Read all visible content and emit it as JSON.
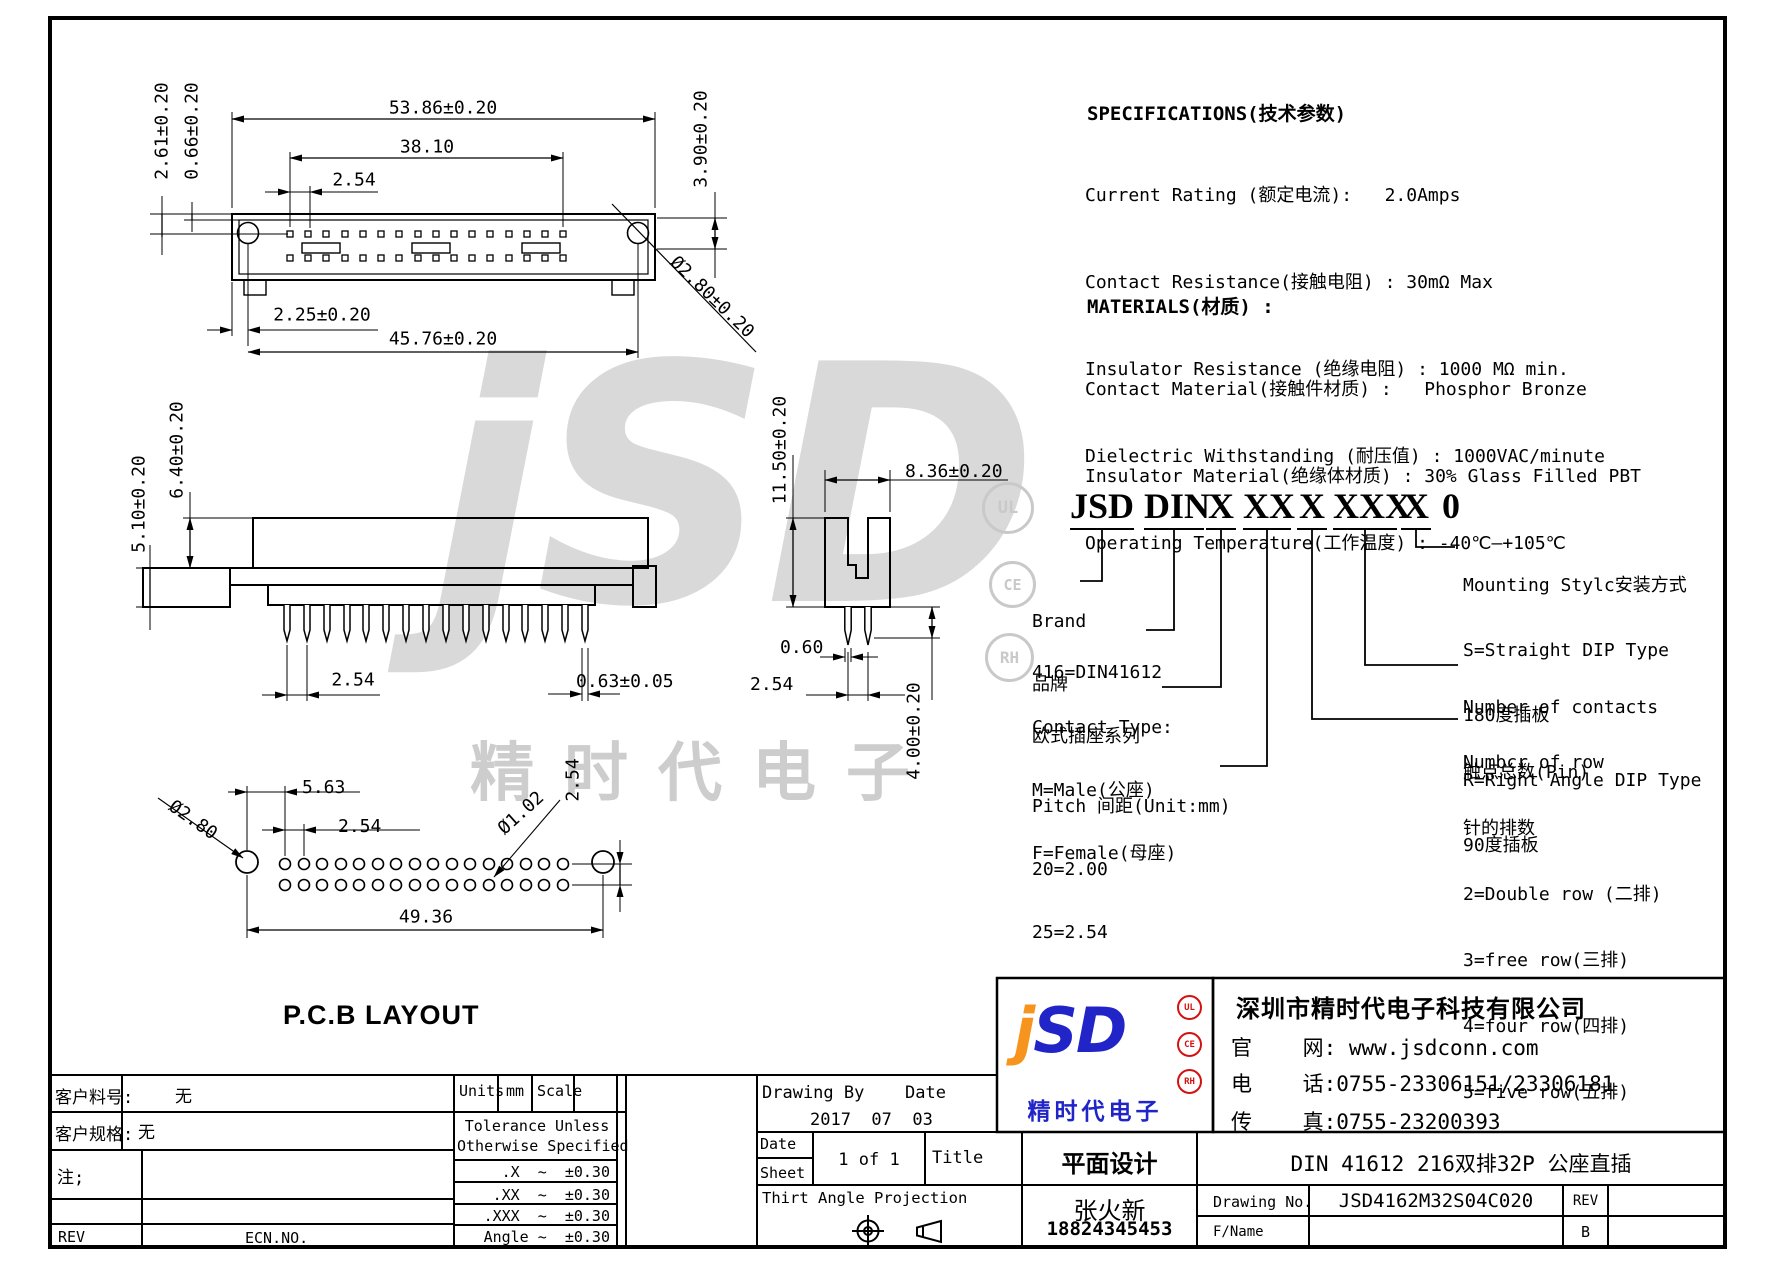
{
  "specs": {
    "title": "SPECIFICATIONS(技术参数)",
    "lines": [
      "Current Rating (额定电流):   2.0Amps",
      "Contact Resistance(接触电阻) : 30mΩ Max",
      "Insulator Resistance (绝缘电阻) : 1000 MΩ min.",
      "Dielectric Withstanding (耐压值) : 1000VAC/minute",
      "Operating Temperature(工作温度) : -40℃—+105℃"
    ]
  },
  "materials": {
    "title": "MATERIALS(材质) :",
    "lines": [
      "Contact Material(接触件材质) :   Phosphor Bronze",
      "Insulator Material(绝缘体材质) : 30% Glass Filled PBT"
    ]
  },
  "part_number": {
    "groups": [
      "JSD",
      "DIN",
      "X",
      "XX",
      "X",
      "XXX",
      "X",
      "0"
    ],
    "brand": {
      "l0": "Brand",
      "l1": "品牌"
    },
    "series": {
      "l0": "416=DIN41612",
      "l1": "欧式插座系列"
    },
    "contact_type": {
      "l0": "Contact Type:",
      "l1": "M=Male(公座)",
      "l2": "F=Female(母座)"
    },
    "pitch": {
      "l0": "Pitch 间距(Unit:mm)",
      "l1": "20=2.00",
      "l2": "25=2.54"
    },
    "mounting": {
      "l0": "Mounting Stylc安装方式",
      "l1": "S=Straight DIP Type",
      "l2": "180度插板",
      "l3": "R=Right Angle DIP Type",
      "l4": "90度插板"
    },
    "contacts": {
      "l0": "Number of contacts",
      "l1": "触点总数(Pin)"
    },
    "rows": {
      "l0": "Numbcr of row",
      "l1": "针的排数",
      "l2": "2=Double row (二排)",
      "l3": "3=free row(三排)",
      "l4": "4=four row(四排)",
      "l5": "5=five row(五排)"
    }
  },
  "views": {
    "top": {
      "dim_width": "53.86±0.20",
      "dim_span": "38.10",
      "dim_pitch": "2.54",
      "dim_h1": "2.61±0.20",
      "dim_h2": "0.66±0.20",
      "dim_right": "3.90±0.20",
      "dim_hole": "Ø2.80±0.20",
      "dim_offset": "2.25±0.20",
      "dim_inner": "45.76±0.20"
    },
    "front": {
      "dim_h1": "5.10±0.20",
      "dim_h2": "6.40±0.20",
      "dim_pitch": "2.54",
      "dim_pin": "0.63±0.05"
    },
    "side": {
      "dim_h": "11.50±0.20",
      "dim_w": "8.36±0.20",
      "dim_pin": "0.60",
      "dim_pitch": "2.54",
      "dim_len": "4.00±0.20"
    },
    "pcb": {
      "title": "P.C.B LAYOUT",
      "dim_hole": "Ø2.80",
      "dim_edge": "5.63",
      "dim_pitch": "2.54",
      "dim_pin": "Ø1.02",
      "dim_row": "2.54",
      "dim_span": "49.36"
    }
  },
  "title_block": {
    "customer_pn_label": "客户料号:",
    "customer_pn": "无",
    "customer_spec_label": "客户规格:",
    "customer_spec": "无",
    "note_label": "注;",
    "rev_label": "REV",
    "ecn": "ECN.NO.",
    "units_label": "Units",
    "units": "mm",
    "scale_label": "Scale",
    "tol_title1": "Tolerance Unless",
    "tol_title2": "Otherwise Specified",
    "tol_x": ".X  ~  ±0.30",
    "tol_xx": ".XX  ~  ±0.30",
    "tol_xxx": ".XXX  ~  ±0.30",
    "tol_angle": "Angle ~  ±0.30",
    "drawing_by_label": "Drawing By",
    "date_label": "Date",
    "date": "2017  07  03",
    "date_cell": "Date",
    "sheet_cell": "Sheet",
    "sheet": "1 of 1",
    "title_label": "Title",
    "title": "平面设计",
    "projection": "Thirt Angle Projection",
    "designer": "张火新",
    "phone": "18824345453",
    "company": "深圳市精时代电子科技有限公司",
    "website": "官    网: www.jsdconn.com",
    "tel": "电    话:0755-23306151/23306181",
    "fax": "传    真:0755-23200393",
    "product_title": "DIN  41612 216双排32P 公座直插",
    "drawing_no_label": "Drawing No.",
    "drawing_no": "JSD4162M32S04C020",
    "rev_col_label": "REV",
    "fname_label": "F/Name",
    "rev": "B"
  },
  "logo": {
    "j": "j",
    "sd": "SD",
    "cn": "精时代电子",
    "badge_ul": "UL",
    "badge_ce": "CE",
    "badge_rh": "RH"
  },
  "watermark": {
    "letters": "jSD",
    "cn": "精时代电子",
    "badge_ul": "UL",
    "badge_ce": "CE",
    "badge_rh": "RH"
  },
  "colors": {
    "logo_blue": "#2125c8",
    "logo_orange": "#f7941d",
    "badge_red": "#d41111",
    "watermark_gray": "#d9d9d9"
  }
}
